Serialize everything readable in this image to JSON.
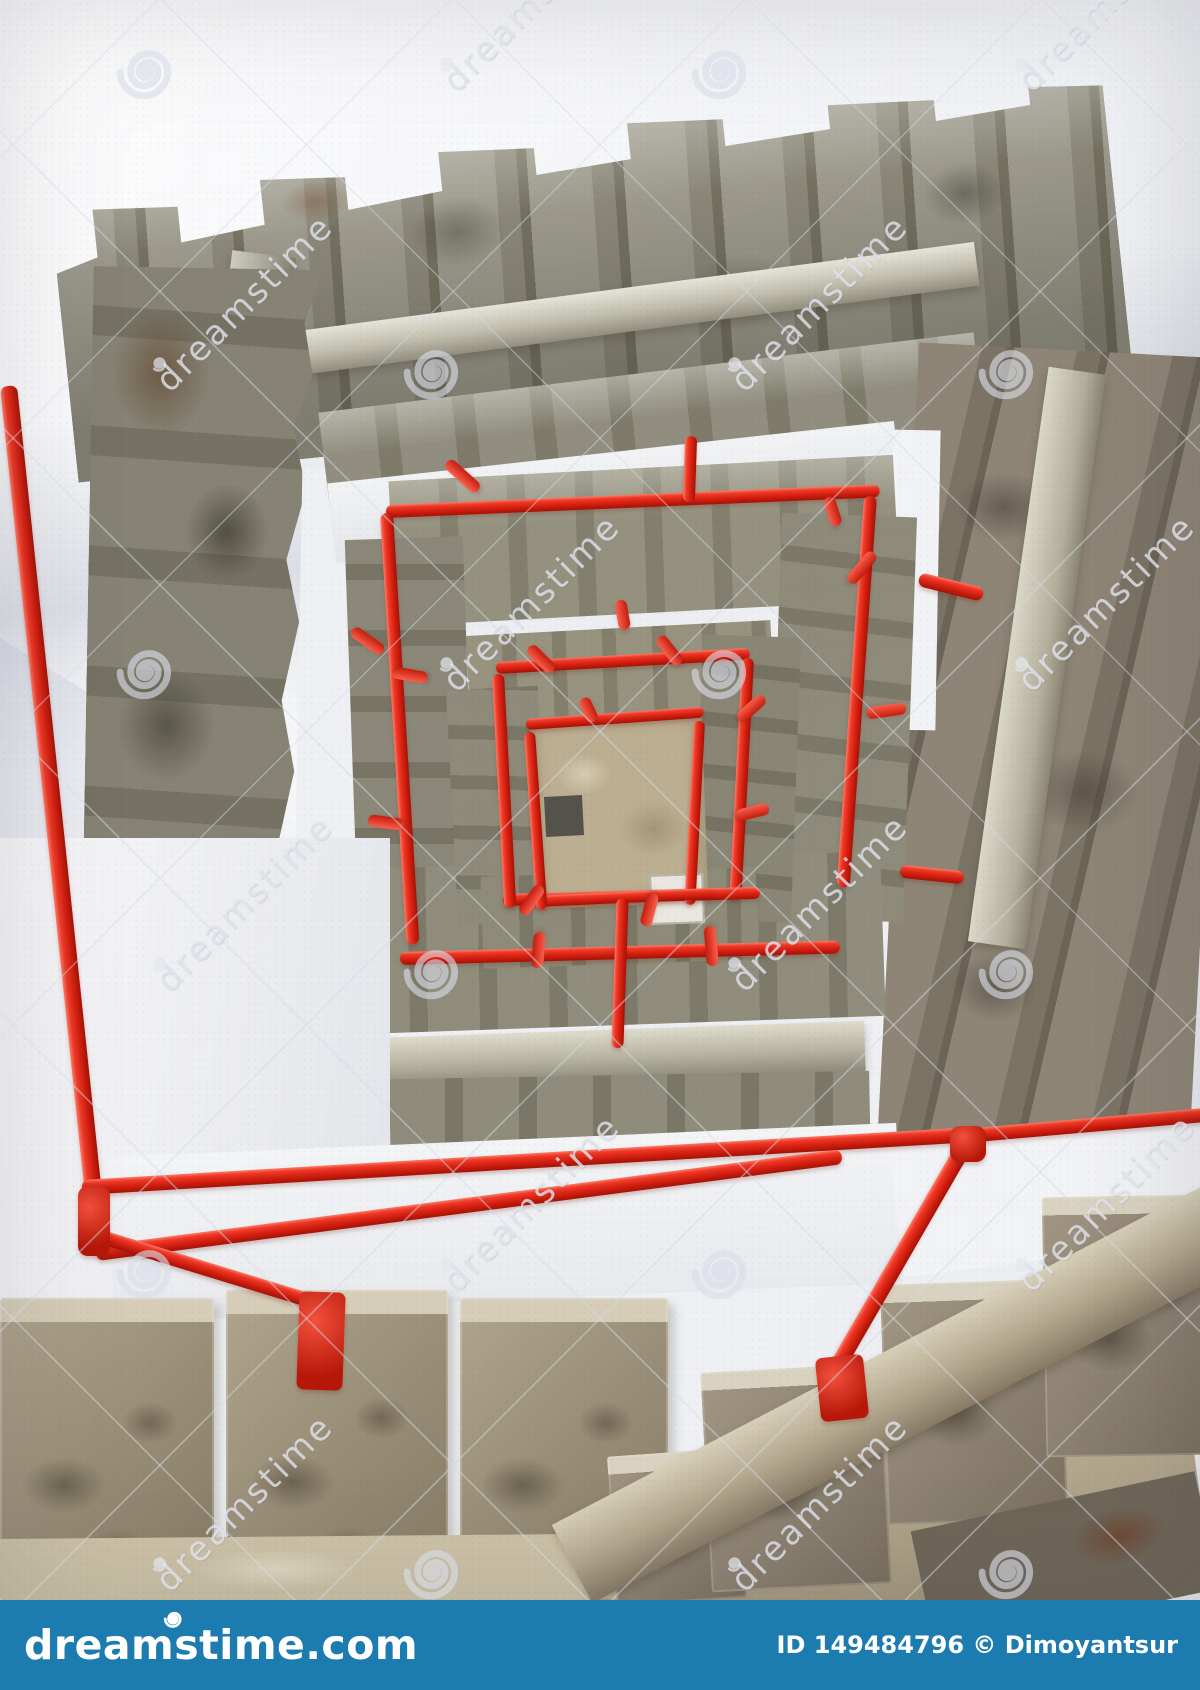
{
  "photo": {
    "description": "Upward view inside a square spiral stairwell under construction: raw concrete steps winding around, red painted handrails forming nested squares, white walls, tan landing floor at the center",
    "palette": {
      "wall_white": "#f4f5f7",
      "concrete_grey": "#8a8779",
      "concrete_dark": "#73705f",
      "stringer_light": "#c0bdac",
      "foreground_tan": "#a79d87",
      "center_floor_tan": "#bcae90",
      "railing_red": "#e0261a",
      "railing_red_dark": "#a31206"
    }
  },
  "watermark": {
    "text": "dreamstime",
    "text_positions": [
      {
        "x": 435,
        "y": 72
      },
      {
        "x": 1010,
        "y": 72
      },
      {
        "x": 148,
        "y": 372
      },
      {
        "x": 723,
        "y": 372
      },
      {
        "x": 1298,
        "y": 372
      },
      {
        "x": 435,
        "y": 672
      },
      {
        "x": 1010,
        "y": 672
      },
      {
        "x": 148,
        "y": 972
      },
      {
        "x": 723,
        "y": 972
      },
      {
        "x": 1298,
        "y": 972
      },
      {
        "x": 435,
        "y": 1272
      },
      {
        "x": 1010,
        "y": 1272
      },
      {
        "x": 148,
        "y": 1572
      },
      {
        "x": 723,
        "y": 1572
      },
      {
        "x": 1298,
        "y": 1572
      }
    ],
    "spiral_positions": [
      {
        "x": 148,
        "y": 72
      },
      {
        "x": 723,
        "y": 72
      },
      {
        "x": 1298,
        "y": 72
      },
      {
        "x": 435,
        "y": 372
      },
      {
        "x": 1010,
        "y": 372
      },
      {
        "x": 148,
        "y": 672
      },
      {
        "x": 723,
        "y": 672
      },
      {
        "x": 1298,
        "y": 672
      },
      {
        "x": 435,
        "y": 972
      },
      {
        "x": 1010,
        "y": 972
      },
      {
        "x": 148,
        "y": 1272
      },
      {
        "x": 723,
        "y": 1272
      },
      {
        "x": 1298,
        "y": 1272
      },
      {
        "x": 435,
        "y": 1572
      },
      {
        "x": 1010,
        "y": 1572
      }
    ]
  },
  "railing_stubs": [
    {
      "x": 447,
      "y": 462,
      "a": -48,
      "l": 42
    },
    {
      "x": 352,
      "y": 630,
      "a": -55,
      "l": 38
    },
    {
      "x": 392,
      "y": 672,
      "a": -80,
      "l": 36
    },
    {
      "x": 874,
      "y": 553,
      "a": 40,
      "l": 38
    },
    {
      "x": 906,
      "y": 708,
      "a": 82,
      "l": 40
    },
    {
      "x": 368,
      "y": 820,
      "a": -82,
      "l": 36
    },
    {
      "x": 529,
      "y": 647,
      "a": -45,
      "l": 34
    },
    {
      "x": 659,
      "y": 637,
      "a": -38,
      "l": 34
    },
    {
      "x": 764,
      "y": 697,
      "a": 48,
      "l": 34
    },
    {
      "x": 769,
      "y": 808,
      "a": 76,
      "l": 34
    },
    {
      "x": 522,
      "y": 914,
      "a": 215,
      "l": 34
    },
    {
      "x": 645,
      "y": 926,
      "a": 195,
      "l": 34
    },
    {
      "x": 583,
      "y": 698,
      "a": -25,
      "l": 26
    },
    {
      "x": 620,
      "y": 600,
      "a": -10,
      "l": 30
    },
    {
      "x": 828,
      "y": 497,
      "a": -18,
      "l": 30
    },
    {
      "x": 537,
      "y": 968,
      "a": 185,
      "l": 36
    },
    {
      "x": 713,
      "y": 966,
      "a": 175,
      "l": 40
    }
  ],
  "footer": {
    "bar_color": "#1c7cb0",
    "logo_text": "dreamstime.com",
    "credit_text": "ID 149484796 © Dimoyantsur"
  }
}
